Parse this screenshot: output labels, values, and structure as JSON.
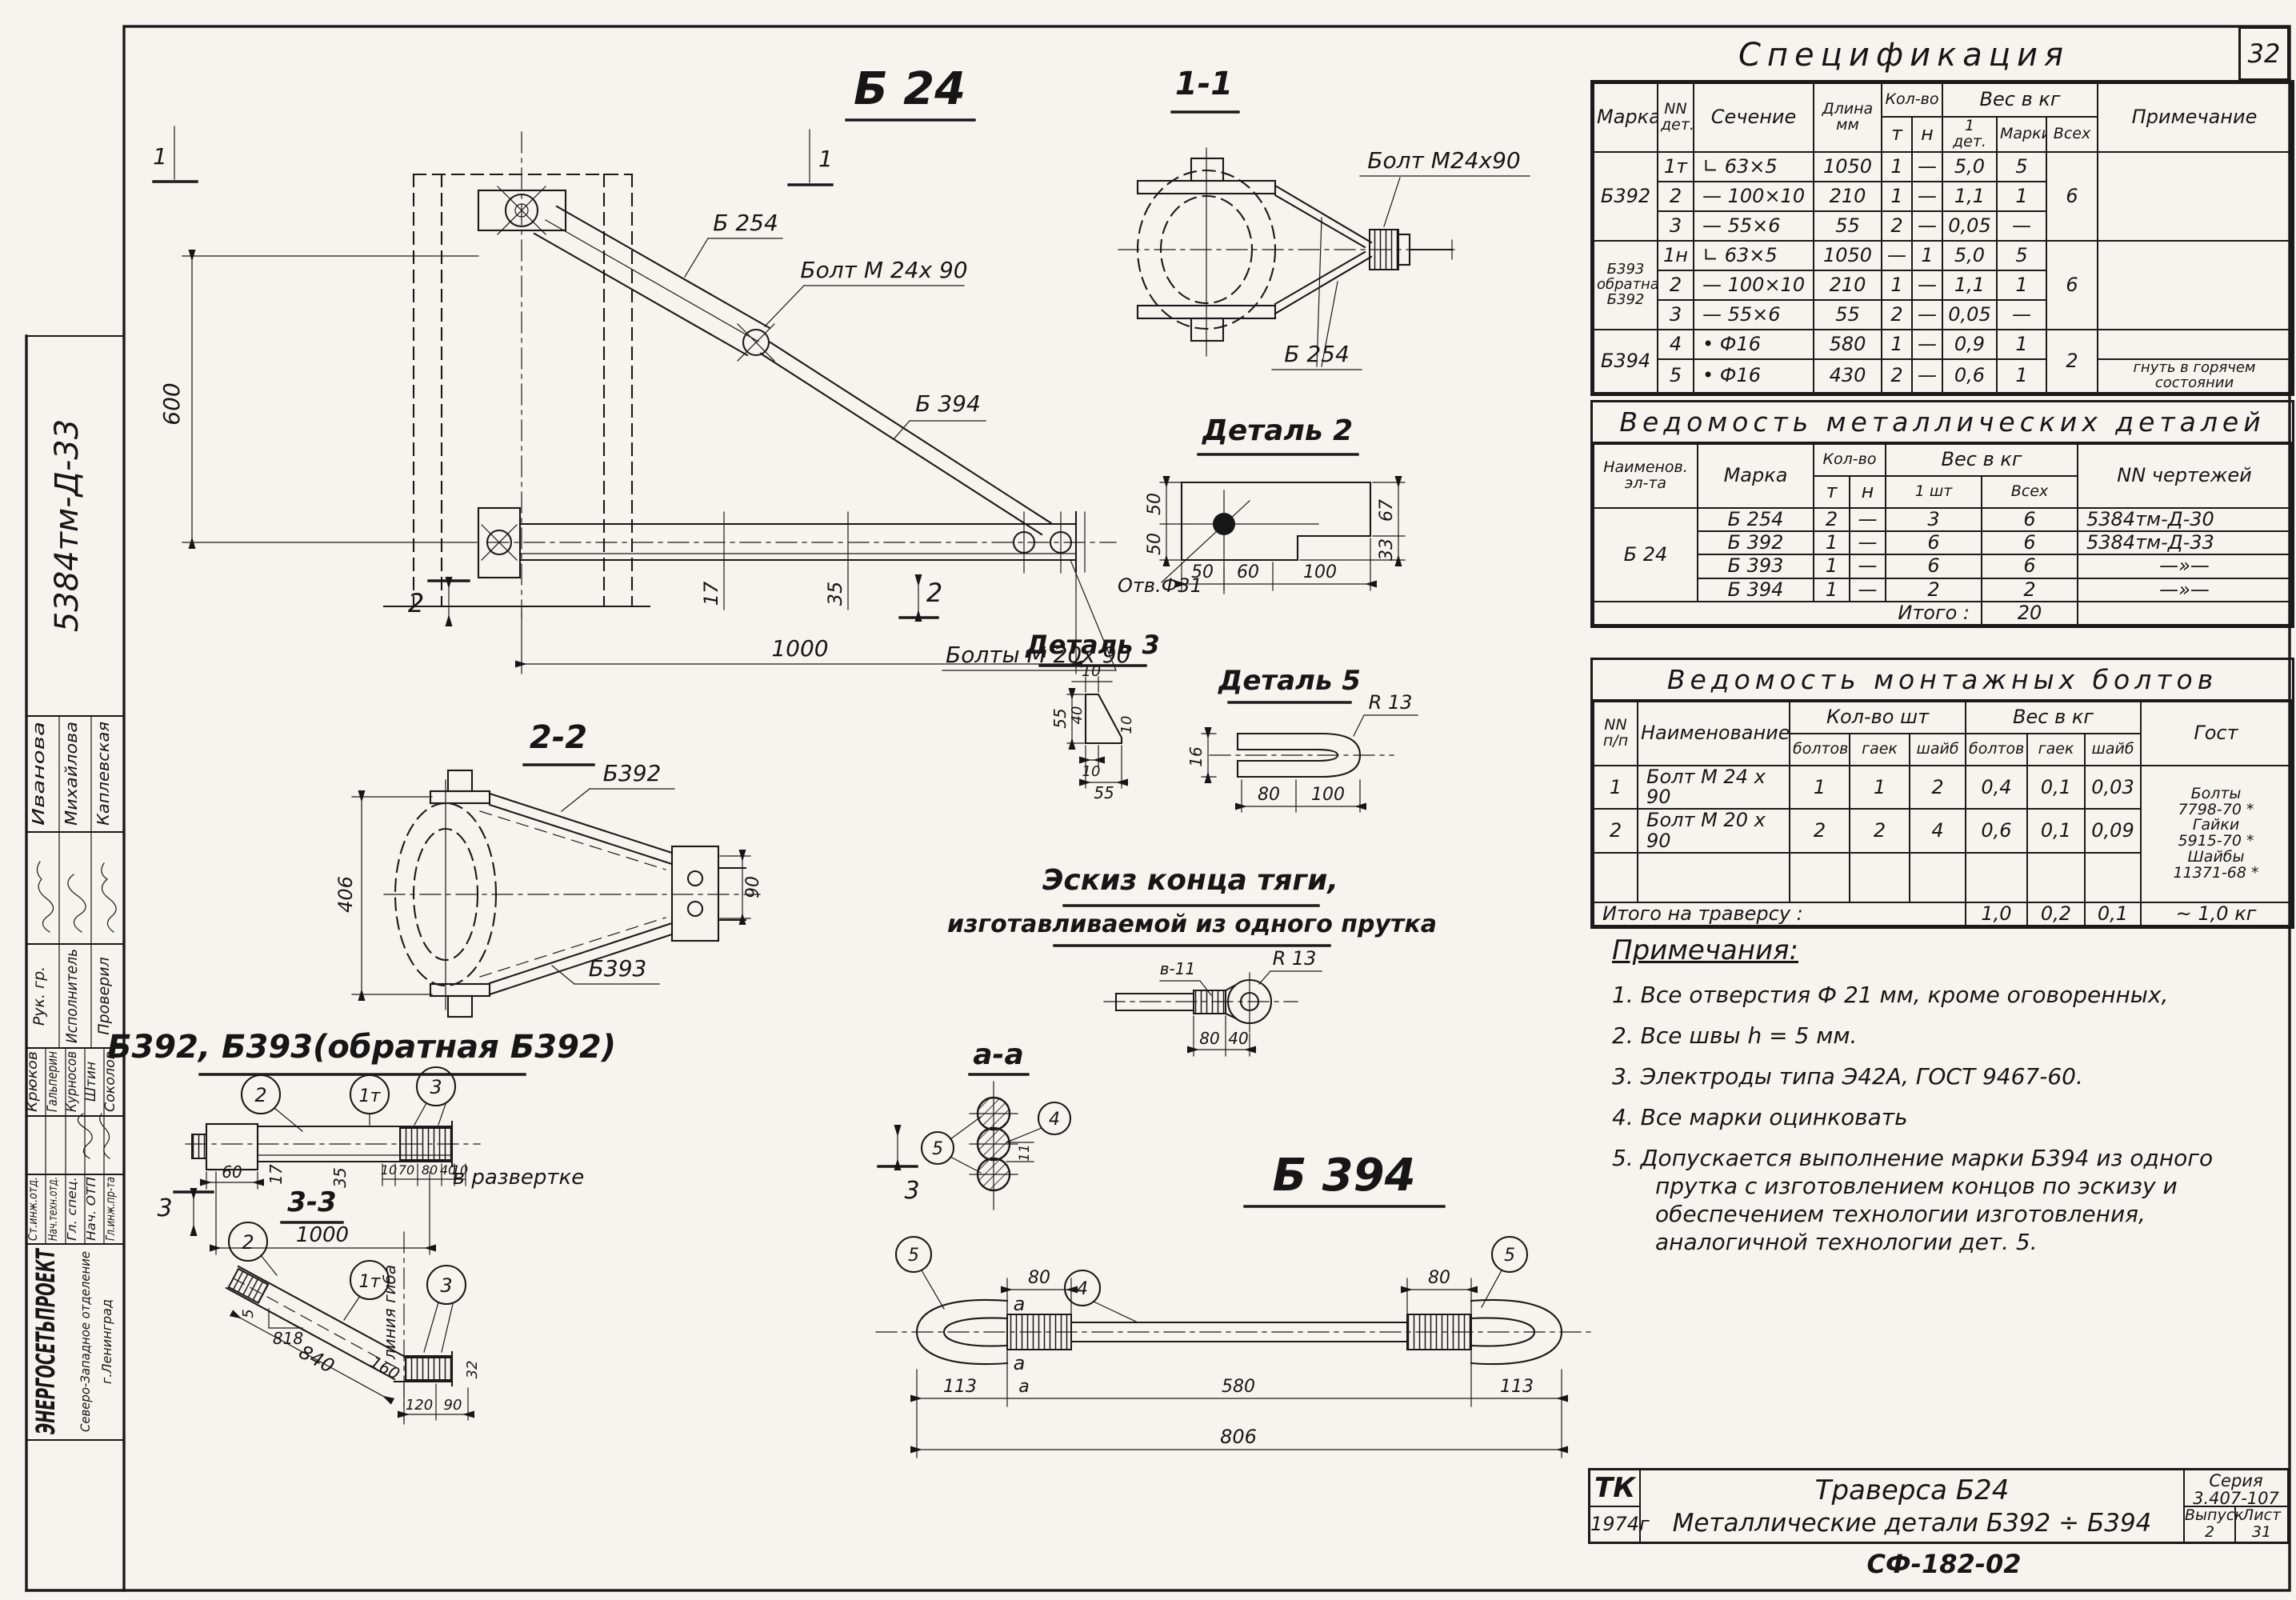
{
  "page": {
    "number": "32",
    "doc_number": "СФ-182-02"
  },
  "stamp": {
    "code": "5384тм-Д-33",
    "group1": {
      "entries": [
        {
          "role": "Рук. гр.",
          "name": "Иванова"
        },
        {
          "role": "Исполнитель",
          "name": "Михайлова"
        },
        {
          "role": "Проверил",
          "name": "Каплевская"
        }
      ]
    },
    "group2": {
      "entries": [
        {
          "role": "Ст.инж.отд.",
          "name": "Крюков"
        },
        {
          "role": "Нач.техн.отд.",
          "name": "Гальперин"
        },
        {
          "role": "Гл. спец.",
          "name": "Курносов"
        },
        {
          "role": "Нач. ОТП",
          "name": "Штин"
        },
        {
          "role": "Гл.инж.пр-та",
          "name": "Соколов"
        }
      ]
    },
    "org": {
      "name": "ЭНЕРГОСЕТЬПРОЕКТ",
      "branch": "Северо-Западное отделение",
      "city": "г.Ленинград"
    }
  },
  "spec": {
    "title": "Спецификация",
    "h": {
      "marka": "Марка",
      "det": "NN\nдет.",
      "sechenie": "Сечение",
      "dlina": "Длина\nмм",
      "kolvo": "Кол-во",
      "t": "т",
      "n": "н",
      "ves": "Вес в кг",
      "det1": "1 дет.",
      "marki": "Марки",
      "vseh": "Всех",
      "prim": "Примечание"
    },
    "rows": [
      [
        {
          "t": "Б392",
          "r": 3
        },
        {
          "t": "1т"
        },
        {
          "t": "∟ 63×5",
          "k": "l"
        },
        {
          "t": "1050"
        },
        {
          "t": "1"
        },
        {
          "t": "—"
        },
        {
          "t": "5,0"
        },
        {
          "t": "5"
        },
        {
          "t": "6",
          "r": 3
        },
        {
          "t": "",
          "r": 3
        }
      ],
      [
        {
          "t": "2"
        },
        {
          "t": "— 100×10",
          "k": "l"
        },
        {
          "t": "210"
        },
        {
          "t": "1"
        },
        {
          "t": "—"
        },
        {
          "t": "1,1"
        },
        {
          "t": "1"
        }
      ],
      [
        {
          "t": "3"
        },
        {
          "t": "— 55×6",
          "k": "l"
        },
        {
          "t": "55"
        },
        {
          "t": "2"
        },
        {
          "t": "—"
        },
        {
          "t": "0,05"
        },
        {
          "t": "—"
        }
      ],
      [
        {
          "t": "Б393\nобратная\nБ392",
          "r": 3,
          "k": "sm2"
        },
        {
          "t": "1н"
        },
        {
          "t": "∟ 63×5",
          "k": "l"
        },
        {
          "t": "1050"
        },
        {
          "t": "—"
        },
        {
          "t": "1"
        },
        {
          "t": "5,0"
        },
        {
          "t": "5"
        },
        {
          "t": "6",
          "r": 3
        },
        {
          "t": "",
          "r": 3
        }
      ],
      [
        {
          "t": "2"
        },
        {
          "t": "— 100×10",
          "k": "l"
        },
        {
          "t": "210"
        },
        {
          "t": "1"
        },
        {
          "t": "—"
        },
        {
          "t": "1,1"
        },
        {
          "t": "1"
        }
      ],
      [
        {
          "t": "3"
        },
        {
          "t": "— 55×6",
          "k": "l"
        },
        {
          "t": "55"
        },
        {
          "t": "2"
        },
        {
          "t": "—"
        },
        {
          "t": "0,05"
        },
        {
          "t": "—"
        }
      ],
      [
        {
          "t": "Б394",
          "r": 2
        },
        {
          "t": "4"
        },
        {
          "t": "•  Ф16",
          "k": "l"
        },
        {
          "t": "580"
        },
        {
          "t": "1"
        },
        {
          "t": "—"
        },
        {
          "t": "0,9"
        },
        {
          "t": "1"
        },
        {
          "t": "2",
          "r": 2
        },
        {
          "t": ""
        }
      ],
      [
        {
          "t": "5"
        },
        {
          "t": "•  Ф16",
          "k": "l"
        },
        {
          "t": "430"
        },
        {
          "t": "2"
        },
        {
          "t": "—"
        },
        {
          "t": "0,6"
        },
        {
          "t": "1"
        },
        {
          "t": "гнуть в горячем состоянии",
          "k": "sm2"
        }
      ]
    ]
  },
  "metal": {
    "title": "Ведомость    металлических    деталей",
    "h": {
      "naimen": "Наименов.\nэл-та",
      "marka": "Марка",
      "kolvo": "Кол-во",
      "t": "т",
      "n": "н",
      "ves": "Вес  в  кг",
      "sht1": "1 шт",
      "vseh": "Всех",
      "nn": "NN чертежей"
    },
    "rows": [
      [
        {
          "t": "Б 24",
          "r": 4
        },
        {
          "t": "Б 254"
        },
        {
          "t": "2"
        },
        {
          "t": "—"
        },
        {
          "t": "3"
        },
        {
          "t": "6"
        },
        {
          "t": "5384тм-Д-30",
          "k": "l"
        }
      ],
      [
        {
          "t": "Б 392"
        },
        {
          "t": "1"
        },
        {
          "t": "—"
        },
        {
          "t": "6"
        },
        {
          "t": "6"
        },
        {
          "t": "5384тм-Д-33",
          "k": "l"
        }
      ],
      [
        {
          "t": "Б 393"
        },
        {
          "t": "1"
        },
        {
          "t": "—"
        },
        {
          "t": "6"
        },
        {
          "t": "6"
        },
        {
          "t": "—»—"
        }
      ],
      [
        {
          "t": "Б 394"
        },
        {
          "t": "1"
        },
        {
          "t": "—"
        },
        {
          "t": "2"
        },
        {
          "t": "2"
        },
        {
          "t": "—»—"
        }
      ],
      [
        {
          "t": "Итого :",
          "c": 5,
          "k": "r"
        },
        {
          "t": "20"
        },
        {
          "t": ""
        }
      ]
    ]
  },
  "bolts": {
    "title": "Ведомость    монтажных    болтов",
    "h": {
      "nn": "NN\nп/п",
      "naimen": "Наименование",
      "kolvo": "Кол-во  шт",
      "boltov": "болтов",
      "gaek": "гаек",
      "shaib": "шайб",
      "ves": "Вес  в  кг",
      "boltov2": "болтов",
      "gaek2": "гаек",
      "shaib2": "шайб",
      "gost": "Гост"
    },
    "rows": [
      [
        {
          "t": "1"
        },
        {
          "t": "Болт М 24 х 90",
          "k": "l"
        },
        {
          "t": "1"
        },
        {
          "t": "1"
        },
        {
          "t": "2"
        },
        {
          "t": "0,4"
        },
        {
          "t": "0,1"
        },
        {
          "t": "0,03"
        },
        {
          "t": "Болты\n7798-70 *\nГайки\n5915-70 *\nШайбы\n11371-68 *",
          "r": 3,
          "k": "sm"
        }
      ],
      [
        {
          "t": "2"
        },
        {
          "t": "Болт М 20 х 90",
          "k": "l"
        },
        {
          "t": "2"
        },
        {
          "t": "2"
        },
        {
          "t": "4"
        },
        {
          "t": "0,6"
        },
        {
          "t": "0,1"
        },
        {
          "t": "0,09"
        }
      ],
      [
        {
          "t": "",
          "k": "tall"
        },
        {
          "t": ""
        },
        {
          "t": ""
        },
        {
          "t": ""
        },
        {
          "t": ""
        },
        {
          "t": ""
        },
        {
          "t": ""
        },
        {
          "t": ""
        }
      ],
      [
        {
          "t": "Итого  на  траверсу :",
          "c": 5,
          "k": "l"
        },
        {
          "t": "1,0"
        },
        {
          "t": "0,2"
        },
        {
          "t": "0,1"
        },
        {
          "t": "~ 1,0 кг"
        }
      ]
    ]
  },
  "notes": {
    "title": "Примечания:",
    "items": [
      "1.  Все  отверстия  Ф 21 мм, кроме  оговоренных,",
      "2.  Все  швы  h = 5 мм.",
      "3.  Электроды  типа  Э42А,   ГОСТ 9467-60.",
      "4.  Все  марки  оцинковать",
      "5.  Допускается выполнение  марки  Б394  из одного прутка с изготовлением  концов  по эскизу  и обеспечением  технологии  изготовления, аналогичной  технологии  дет. 5."
    ]
  },
  "title_block": {
    "tk": "ТК",
    "year": "1974г",
    "line1": "Траверса  Б24",
    "line2": "Металлические  детали  Б392 ÷ Б394",
    "series_label": "Серия",
    "series": "3.407-107",
    "issue_label": "Выпуск",
    "issue": "2",
    "sheet_label": "Лист",
    "sheet": "31"
  },
  "drawings": {
    "main": {
      "title": "Б 24",
      "sec1": "1",
      "sec2": "2",
      "label_b254": "Б 254",
      "label_bolt24": "Болт М 24х 90",
      "label_b394": "Б 394",
      "label_bolts20": "Болты М 20х 90",
      "dim600": "600",
      "dim1000": "1000",
      "dim17": "17",
      "dim35": "35"
    },
    "v11": {
      "title": "1-1",
      "label_bolt24": "Болт М24х90",
      "label_b254": "Б 254"
    },
    "d2": {
      "title": "Деталь 2",
      "hole": "Отв.Ф31",
      "d50a": "50",
      "d50b": "50",
      "d50c": "50",
      "d60": "60",
      "d100": "100",
      "d67": "67",
      "d33": "33"
    },
    "d3": {
      "title": "Деталь 3",
      "t10": "10",
      "l55": "55",
      "l40": "40",
      "r10": "10",
      "b10": "10",
      "b55": "55"
    },
    "d5": {
      "title": "Деталь 5",
      "r13": "R 13",
      "d16": "16",
      "d80": "80",
      "d100": "100"
    },
    "sketch": {
      "title1": "Эскиз  конца  тяги,",
      "title2": "изготавливаемой из одного прутка",
      "v11": "в-11",
      "r13": "R 13",
      "d80": "80",
      "d40": "40"
    },
    "v22": {
      "title": "2-2",
      "b392": "Б392",
      "b393": "Б393",
      "d406": "406",
      "d90": "90"
    },
    "big_label": "Б392, Б393(обратная  Б392)",
    "elev": {
      "balloon2": "2",
      "balloon1t": "1т",
      "balloon3": "3",
      "d60": "60",
      "d17": "17",
      "d35": "35",
      "d10a": "10",
      "d70": "70",
      "d80": "80",
      "d40": "40",
      "d10b": "10",
      "razv": "в развертке",
      "sec3": "3",
      "title33": "3-3",
      "d1000": "1000",
      "d5": "5",
      "d818": "818",
      "d840": "840",
      "d160": "160",
      "d120": "120",
      "d90": "90",
      "d32": "32",
      "bend": "линия гиба"
    },
    "aa": {
      "title": "а-а",
      "b4": "4",
      "b5": "5",
      "d11": "11"
    },
    "b394": {
      "title": "Б 394",
      "b4": "4",
      "b5": "5",
      "d80": "80",
      "da": "а",
      "d113": "113",
      "d580": "580",
      "d806": "806"
    }
  }
}
